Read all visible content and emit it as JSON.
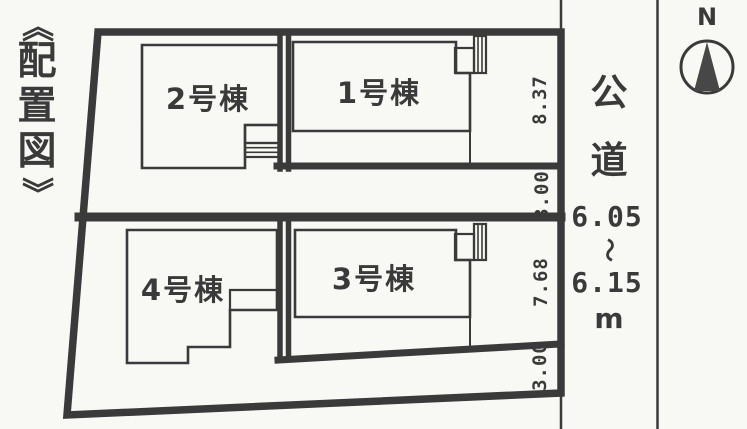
{
  "page": {
    "kind": "site layout plan (scanned real-estate drawing)",
    "colors": {
      "ink": "#3a3a3a",
      "paper": "#f8f8f5"
    }
  },
  "title": {
    "full": "《配置図》",
    "open_mark": "《",
    "characters": [
      "配",
      "置",
      "図"
    ],
    "close_mark": "》"
  },
  "buildings": [
    {
      "label": "1号棟"
    },
    {
      "label": "2号棟"
    },
    {
      "label": "3号棟"
    },
    {
      "label": "4号棟"
    }
  ],
  "dimensions": {
    "upper_parcel_frontage": "8.37",
    "upper_strip": "3.00",
    "lower_parcel_frontage": "7.68",
    "lower_strip": "3.00"
  },
  "road": {
    "name": "公道",
    "name_chars": [
      "公",
      "道"
    ],
    "width_min": "6.05",
    "range_mark": "〜",
    "width_max": "6.15",
    "unit": "m"
  },
  "compass": {
    "north": "N"
  }
}
